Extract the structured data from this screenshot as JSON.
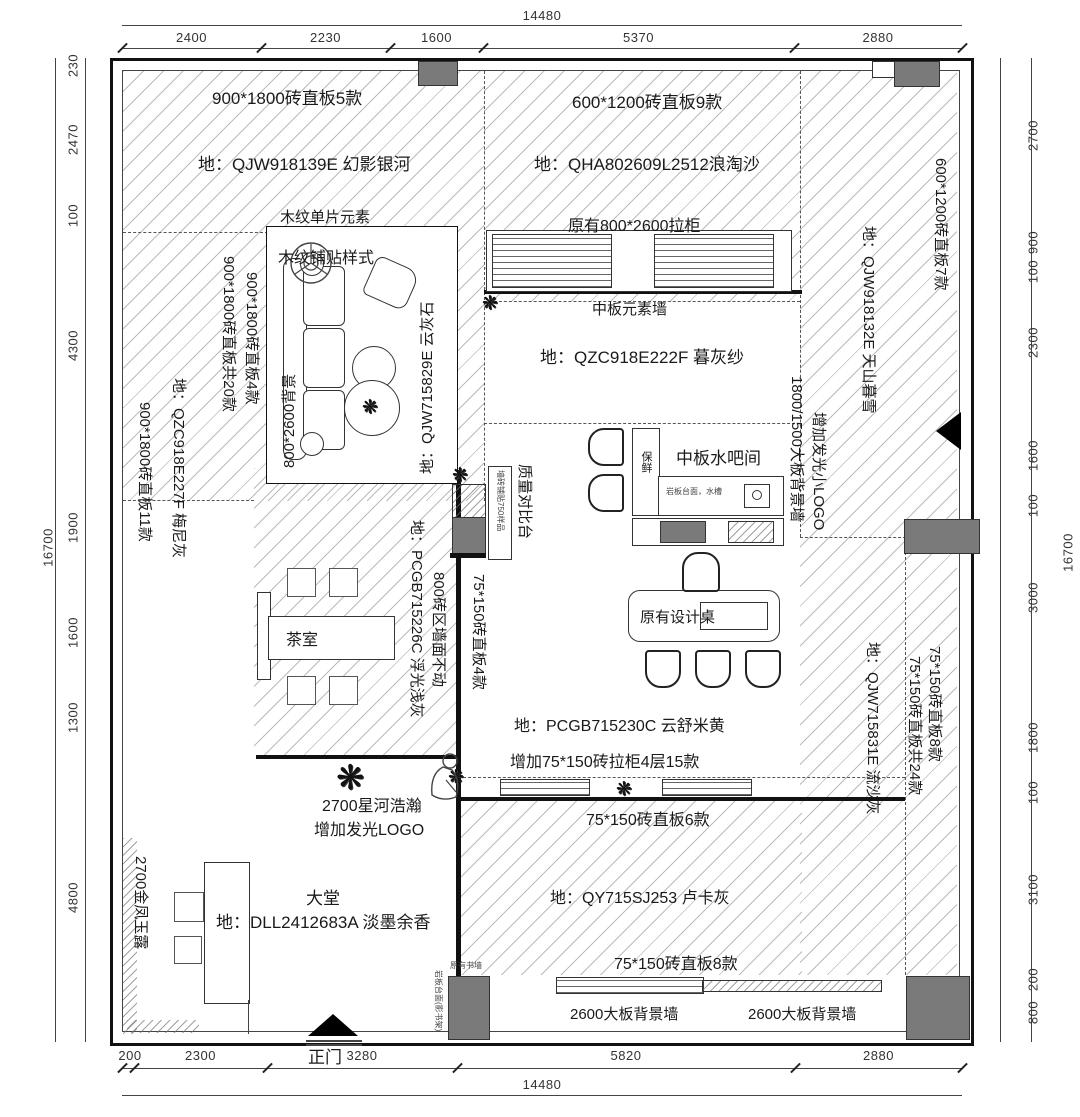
{
  "drawing": {
    "type": "showroom-floor-plan"
  },
  "dims": {
    "top": {
      "overall": "14480",
      "segments": [
        "2400",
        "2230",
        "1600",
        "5370",
        "2880"
      ]
    },
    "bottom": {
      "overall": "14480",
      "segments": [
        "200",
        "2300",
        "3280",
        "5820",
        "2880"
      ]
    },
    "left": {
      "overall": "16700",
      "segments": [
        "230",
        "2470",
        "100",
        "4300",
        "1900",
        "1600",
        "1300",
        "4800"
      ]
    },
    "right": {
      "overall": "16700",
      "segments": [
        "2700",
        "900",
        "100",
        "2300",
        "1600",
        "100",
        "3000",
        "1800",
        "100",
        "3100",
        "200",
        "800"
      ]
    }
  },
  "labels": {
    "entrance": "正门",
    "tl_spec": "900*1800砖直板5款",
    "tl_floor": "地：QJW918139E 幻影银河",
    "wood_element": "木纹单片元素",
    "wood_paste": "木纹铺贴样式",
    "tc_spec": "600*1200砖直板9款",
    "tc_floor": "地：QHA802609L2512浪淘沙",
    "tc_cabinet": "原有800*2600拉柜",
    "midwall": "中板元素墙",
    "center_floor": "地：QZC918E222F 暮灰纱",
    "waterbar": "中板水吧间",
    "waterbar_counter": "岩板台面，水槽",
    "fridge": "保鲜",
    "design_table": "原有设计桌",
    "center_floor2": "地：PCGB715230C 云舒米黄",
    "center_add": "增加75*150砖拉柜4层15款",
    "tea_room": "茶室",
    "star_river": "2700星河浩瀚",
    "add_logo": "增加发光LOGO",
    "lobby": "大堂",
    "lobby_floor": "地：DLL2412683A  淡墨余香",
    "bottom_spec6": "75*150砖直板6款",
    "bottom_floor": "地：QY715SJ253 卢卡灰",
    "bottom_spec8": "75*150砖直板8款",
    "bg_wall_left": "2600大板背景墙",
    "bg_wall_right": "2600大板背景墙",
    "existing_bookwall": "原有书墙",
    "rock_shelf": "岩板台面(影书架)",
    "quality_table": "质量对比台",
    "quality_note": "墙砖铺贴750样品",
    "v_left_20": "900*1800砖直板共20款",
    "v_left_4": "900*1800砖直板4款",
    "v_left_floor": "地：QZC918E227F 梅尼灰",
    "v_left_11": "900*1800砖直板11款",
    "v_sofa_bg": "800*2600背景",
    "v_sofa_floor": "地：QJW715829E 云灰石",
    "v_tea_floor": "地：PCGB715226C 浮光浅灰",
    "v_800zone": "800砖区墙面不动",
    "v_75_4": "75*150砖直板4款",
    "v_right_7": "600*1200砖直板7款",
    "v_right_floor_top": "地：QJW918132E 天山暮雪",
    "v_add_logo_small": "增加发光小LOGO",
    "v_big_bg": "1800/1500大板背景墙",
    "v_right_floor_bottom": "地：QJW715831E 流沙灰",
    "v_75_8": "75*150砖直板8款",
    "v_75_24": "75*150砖直板共24款",
    "v_gold": "2700金凤玉露"
  },
  "icons": {
    "plant": "❋"
  },
  "colors": {
    "line": "#1a1a1a",
    "column_fill": "#7a7a7a",
    "hatch": "#9a9a9a"
  }
}
